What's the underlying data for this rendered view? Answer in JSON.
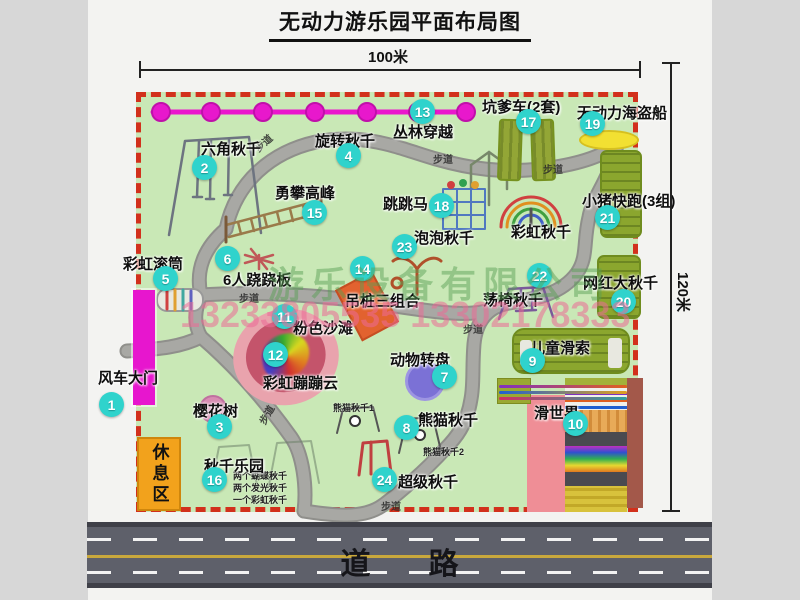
{
  "page": {
    "title": "无动力游乐园平面布局图",
    "dim_width": "100米",
    "dim_height": "120米",
    "road_label": "道路"
  },
  "watermark": {
    "company": "游乐设备有限公司",
    "phone": "13233805535 13302178333"
  },
  "map": {
    "path_label": "步道",
    "rest_area_label": "休息区",
    "unnumbered_swing": "彩虹秋千",
    "attractions": [
      {
        "id": "1",
        "name": "风车大门"
      },
      {
        "id": "2",
        "name": "六角秋千"
      },
      {
        "id": "3",
        "name": "樱花树"
      },
      {
        "id": "4",
        "name": "旋转秋千"
      },
      {
        "id": "5",
        "name": "彩虹滚筒"
      },
      {
        "id": "6",
        "name": "6人跷跷板"
      },
      {
        "id": "7",
        "name": "动物转盘"
      },
      {
        "id": "8",
        "name": "熊猫秋千",
        "notes": [
          "熊猫秋千1",
          "熊猫秋千2"
        ]
      },
      {
        "id": "9",
        "name": "儿童滑索"
      },
      {
        "id": "10",
        "name": "滑世界"
      },
      {
        "id": "11",
        "name": "粉色沙滩"
      },
      {
        "id": "12",
        "name": "彩虹蹦蹦云"
      },
      {
        "id": "13",
        "name": "丛林穿越"
      },
      {
        "id": "14",
        "name": "吊桩三组合"
      },
      {
        "id": "15",
        "name": "勇攀高峰"
      },
      {
        "id": "16",
        "name": "秋千乐园",
        "notes": [
          "两个蝴蝶秋千",
          "两个发光秋千",
          "一个彩虹秋千"
        ]
      },
      {
        "id": "17",
        "name": "坑爹车(2套)"
      },
      {
        "id": "18",
        "name": "跳跳马"
      },
      {
        "id": "19",
        "name": "无动力海盗船"
      },
      {
        "id": "20",
        "name": "网红大秋千"
      },
      {
        "id": "21",
        "name": "小猪快跑(3组)"
      },
      {
        "id": "22",
        "name": "荡椅秋千"
      },
      {
        "id": "23",
        "name": "泡泡秋千"
      },
      {
        "id": "24",
        "name": "超级秋千"
      }
    ]
  }
}
